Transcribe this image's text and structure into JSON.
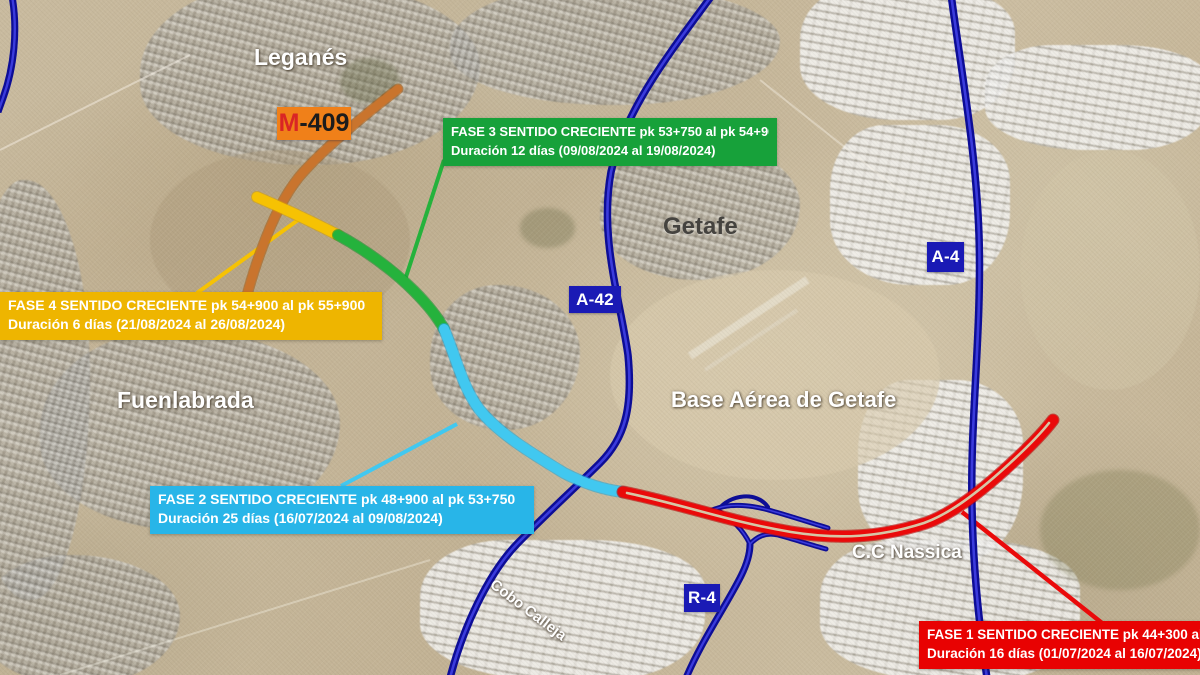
{
  "map": {
    "places": {
      "leganes": "Leganés",
      "getafe": "Getafe",
      "fuenlabrada": "Fuenlabrada",
      "base_aerea": "Base Aérea de Getafe",
      "cc_nassica": "C.C Nassica",
      "cobo_calleja": "Cobo Calleja"
    },
    "road_badges": {
      "m409": {
        "prefix": "M",
        "rest": "-409",
        "bg": "#f08019"
      },
      "a42": {
        "label": "A-42",
        "bg": "#1a1ab5"
      },
      "a4": {
        "label": "A-4",
        "bg": "#1a1ab5"
      },
      "r4": {
        "label": "R-4",
        "bg": "#1a1ab5"
      }
    },
    "phases": {
      "fase1": {
        "line1": "FASE 1 SENTIDO CRECIENTE pk 44+300 al",
        "line2": "Duración 16 días (01/07/2024 al 16/07/2024)",
        "color": "#e80202"
      },
      "fase2": {
        "line1": "FASE 2 SENTIDO CRECIENTE pk 48+900 al pk 53+750",
        "line2": "Duración 25 días (16/07/2024 al 09/08/2024)",
        "color": "#28b5e8"
      },
      "fase3": {
        "line1": "FASE 3 SENTIDO CRECIENTE pk 53+750 al pk 54+900",
        "line2": "Duración 12 días (09/08/2024 al 19/08/2024)",
        "color": "#17a13a"
      },
      "fase4": {
        "line1": "FASE 4 SENTIDO CRECIENTE pk 54+900 al pk 55+900",
        "line2": "Duración 6 días (21/08/2024 al 26/08/2024)",
        "color": "#eeb500"
      }
    },
    "route_colors": {
      "motorway_blue": "#0d0d96",
      "orange_segment": "#c9742d",
      "fase4_yellow": "#f6c203",
      "fase3_green": "#25b23c",
      "fase2_cyan": "#41c8f0",
      "fase1_red": "#ea0a0a"
    }
  }
}
